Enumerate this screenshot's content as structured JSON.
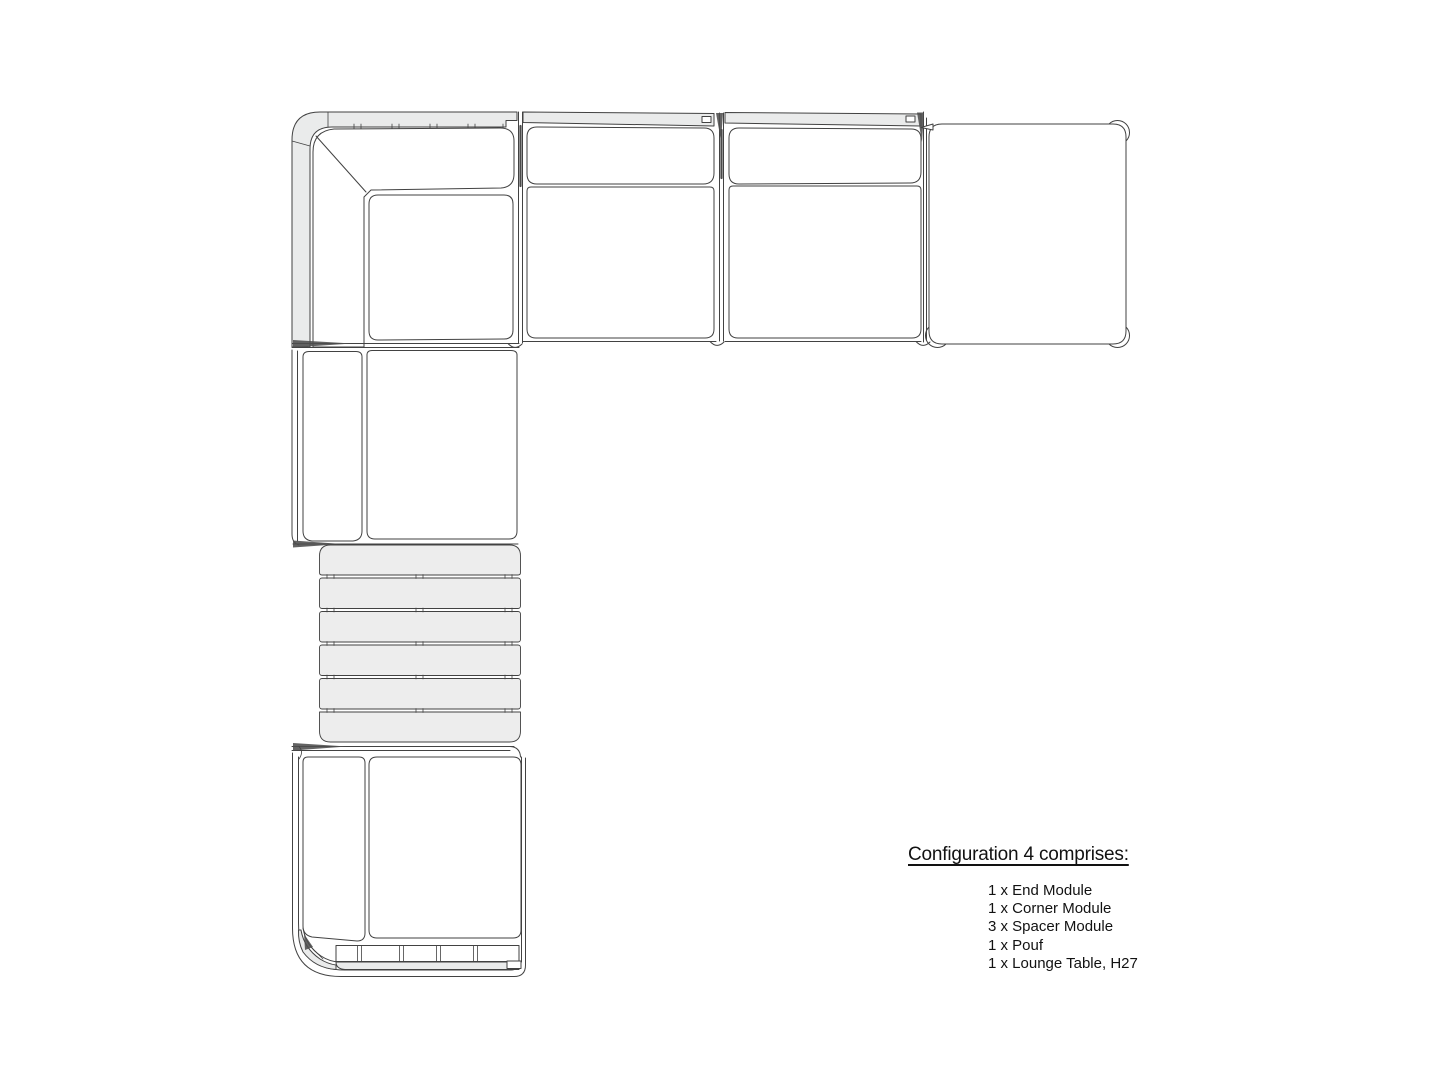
{
  "page": {
    "background_color": "#ffffff"
  },
  "diagram": {
    "stroke_color": "#424242",
    "frame_fill_color": "#eaebeb",
    "slat_fill_color": "#ededed",
    "modules": [
      {
        "name": "corner-module",
        "label": "Corner Module"
      },
      {
        "name": "spacer-module-1",
        "label": "Spacer Module"
      },
      {
        "name": "spacer-module-2",
        "label": "Spacer Module"
      },
      {
        "name": "pouf",
        "label": "Pouf"
      },
      {
        "name": "spacer-module-3",
        "label": "Spacer Module"
      },
      {
        "name": "lounge-table",
        "label": "Lounge Table, H27"
      },
      {
        "name": "end-module",
        "label": "End Module"
      }
    ]
  },
  "legend": {
    "title": "Configuration 4 comprises:",
    "items": [
      "1 x End Module",
      "1 x Corner Module",
      "3 x Spacer Module",
      "1 x Pouf",
      "1 x Lounge Table, H27"
    ]
  }
}
